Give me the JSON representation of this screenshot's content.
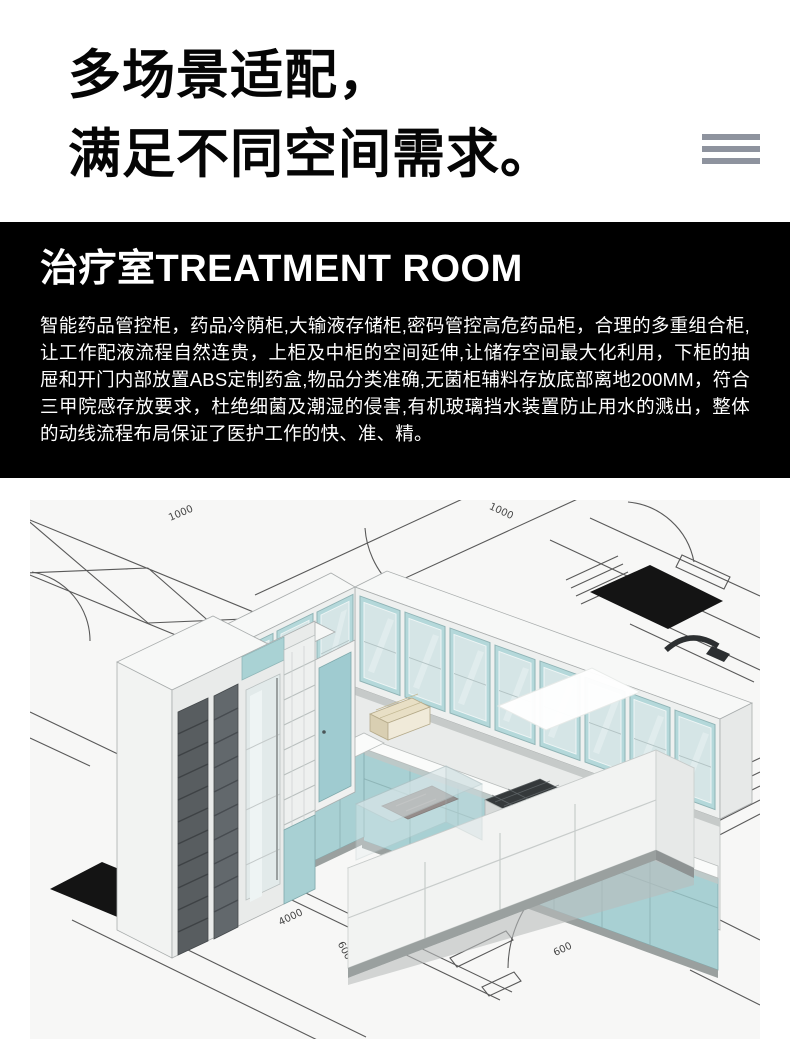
{
  "hero": {
    "title_line1": "多场景适配，",
    "title_line2": "满足不同空间需求。",
    "menu_icon": "hamburger-lines-icon",
    "menu_color": "#8e939e"
  },
  "feature_panel": {
    "bg": "#000000",
    "title": "治疗室TREATMENT ROOM",
    "body": "智能药品管控柜，药品冷荫柜,大输液存储柜,密码管控高危药品柜，合理的多重组合柜,让工作配液流程自然连贵，上柜及中柜的空间延伸,让储存空间最大化利用，下柜的抽屉和开门内部放置ABS定制药盒,物品分类准确,无菌柜辅料存放底部离地200MM，符合三甲院感存放要求，杜绝细菌及潮湿的侵害,有机玻璃挡水装置防止用水的溅出，整体的动线流程布局保证了医护工作的快、准、精。"
  },
  "render": {
    "room_label": "治疗/配液室",
    "dims": {
      "a": "1000",
      "b": "1000",
      "c": "7050",
      "d": "650",
      "e": "700",
      "f": "750",
      "g": "4000",
      "h": "600",
      "i": "600"
    },
    "colors": {
      "cabinet_teal": "#a9d2d4",
      "cabinet_white": "#f3f4f3",
      "mat_black": "#141414",
      "plan_line": "#4c4c4c",
      "floor": "#f7f7f6"
    }
  }
}
